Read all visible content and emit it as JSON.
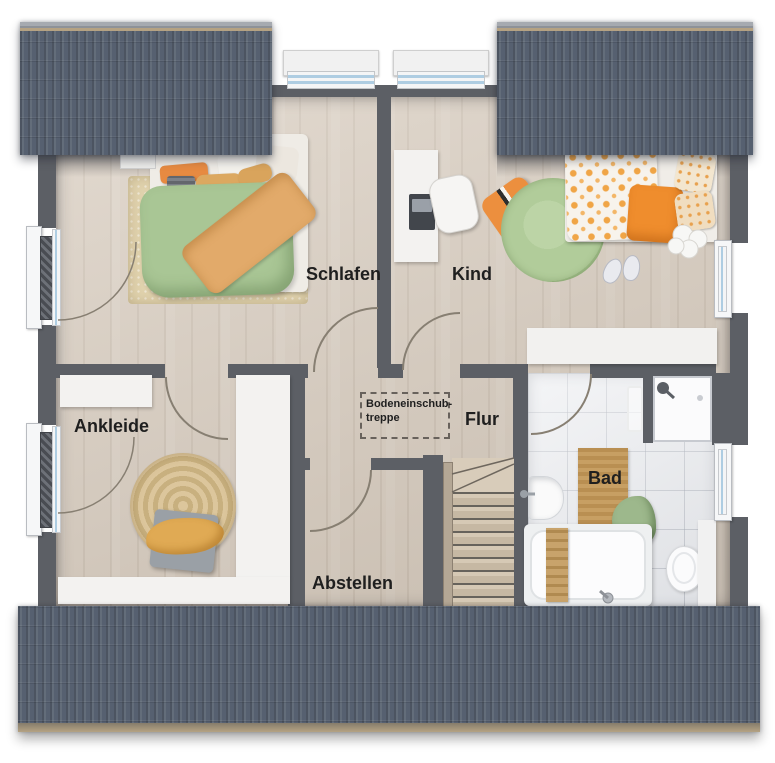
{
  "plan": {
    "type": "floor-plan-top-view",
    "rooms": [
      {
        "id": "schlafen",
        "label": "Schlafen"
      },
      {
        "id": "kind",
        "label": "Kind"
      },
      {
        "id": "ankleide",
        "label": "Ankleide"
      },
      {
        "id": "flur",
        "label": "Flur"
      },
      {
        "id": "abstellen",
        "label": "Abstellen"
      },
      {
        "id": "bad",
        "label": "Bad"
      }
    ],
    "attic_hatch_label": {
      "line1": "Bodeneinschub-",
      "line2": "treppe"
    },
    "palette": {
      "roof": "#59626f",
      "roof_ridge_tan": "#b5a283",
      "wall": "#5c5f65",
      "wood_floor": "#d7cbbd",
      "tile_floor": "#e7e9ed",
      "furniture_white": "#f3f2f0",
      "duvet_green": "#a9c695",
      "blanket_orange": "#e2aa6a",
      "accent_orange": "#ec8f3e",
      "rug_green": "#b1cc9a",
      "rug_jute": "#d3bd93",
      "wood_mat": "#c79f63",
      "towel_green": "#9db88c",
      "label_text": "#1f1f1f"
    }
  }
}
